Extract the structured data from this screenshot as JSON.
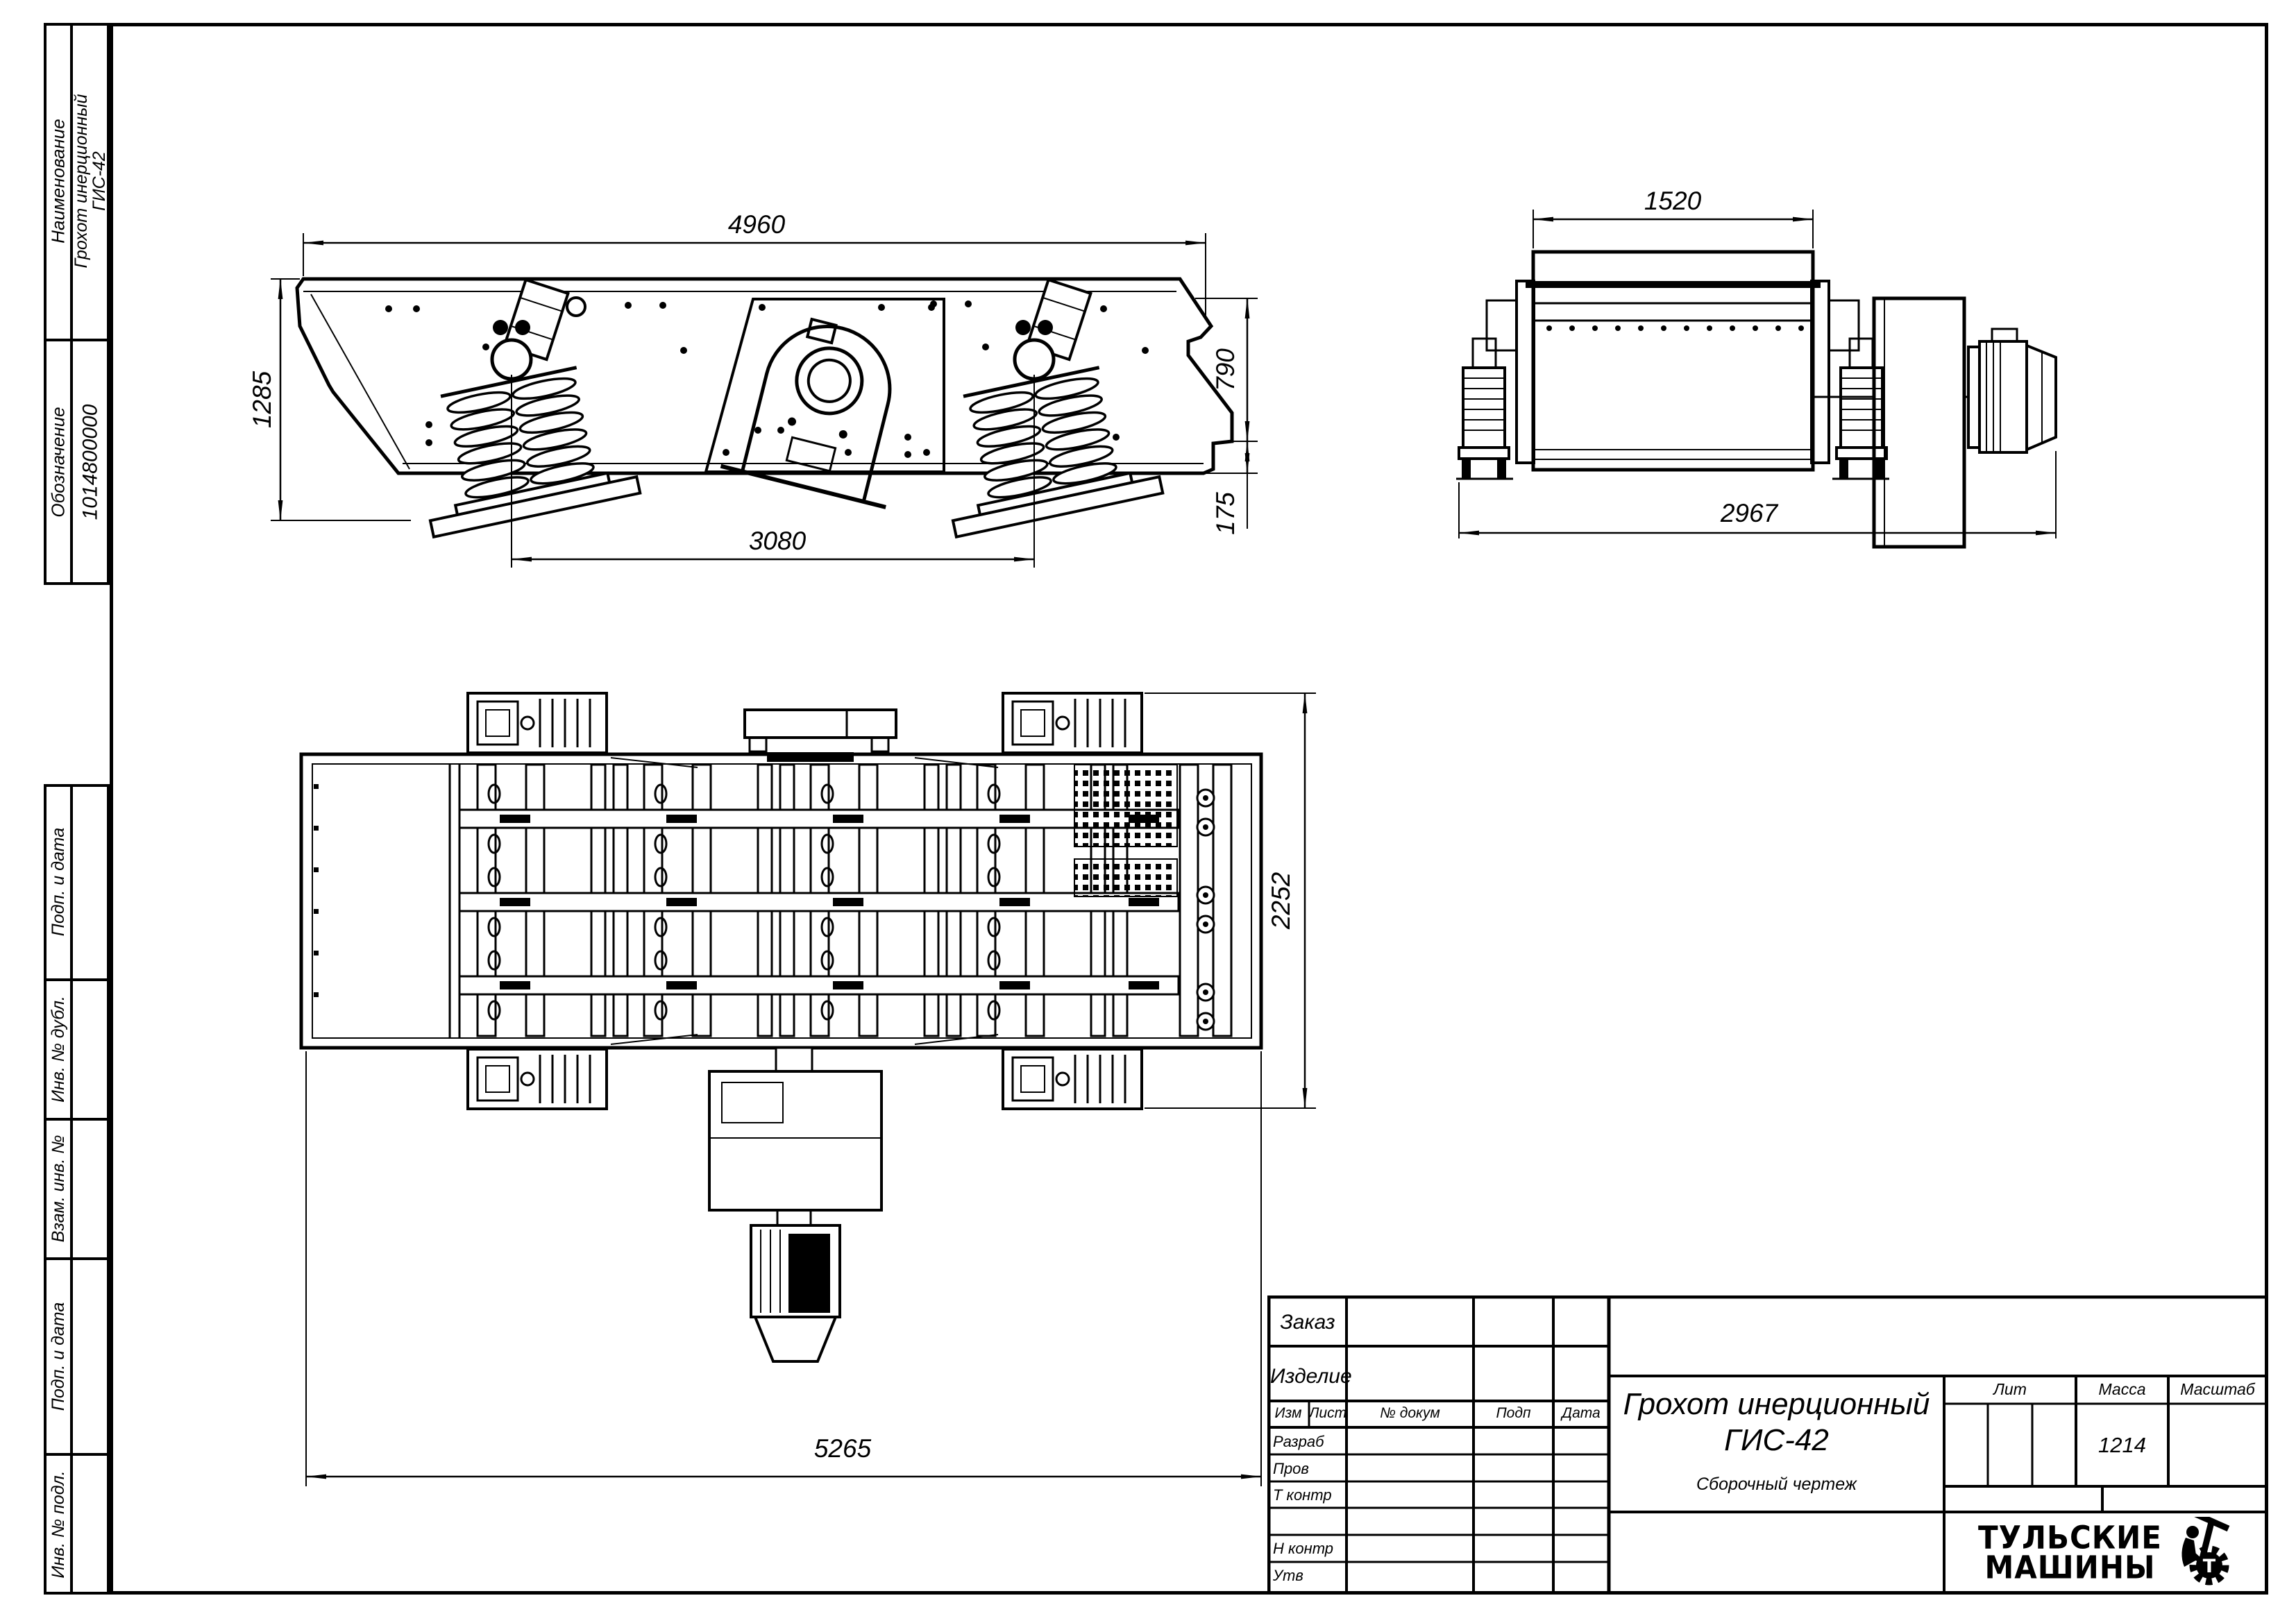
{
  "sheet": {
    "left_strip": {
      "name_label": "Наименование",
      "name_value_1": "Грохот инерционный",
      "name_value_2": "ГИС-42",
      "designation_label": "Обозначение",
      "designation_value": "1014800000",
      "service_rows": [
        "Подп. и дата",
        "Инв. № дубл.",
        "Взам. инв. №",
        "Подп. и дата",
        "Инв. № подл."
      ]
    }
  },
  "dims": {
    "side_length": "4960",
    "side_height": "1285",
    "side_spring_span": "3080",
    "side_right_height": "790",
    "side_lip_height": "175",
    "end_deck_width": "1520",
    "end_overall_width": "2967",
    "plan_width": "2252",
    "plan_length": "5265"
  },
  "title_block": {
    "order_label": "Заказ",
    "product_label": "Изделие",
    "header": {
      "izm": "Изм",
      "list": "Лист",
      "doc": "№ докум",
      "podp": "Подп",
      "data": "Дата"
    },
    "sign_rows": [
      "Разраб",
      "Пров",
      "Т контр",
      "",
      "Н контр",
      "Утв"
    ],
    "doc_title_1": "Грохот инерционный",
    "doc_title_2": "ГИС-42",
    "doc_type": "Сборочный чертеж",
    "lit_label": "Лит",
    "mass_label": "Масса",
    "scale_label": "Масштаб",
    "mass_value": "1214",
    "logo": {
      "line1": "ТУЛЬСКИЕ",
      "line2": "МАШИНЫ",
      "emblem_letter": "Т"
    }
  }
}
